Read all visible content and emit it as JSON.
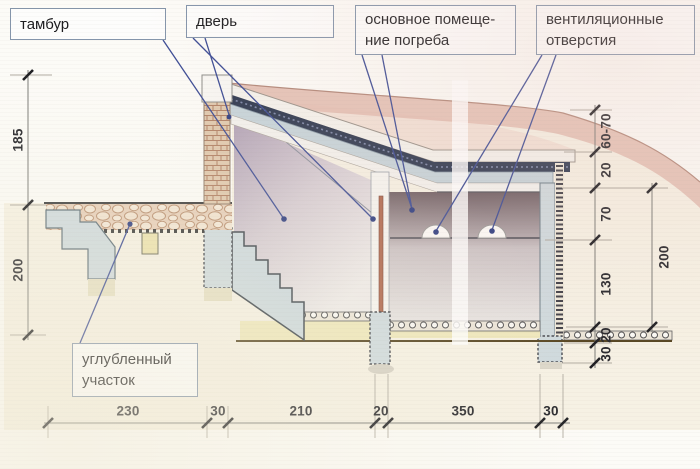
{
  "callouts": {
    "tambur": {
      "text": "тамбур"
    },
    "door": {
      "text": "дверь"
    },
    "main_room": {
      "line1": "основное помеще-",
      "line2": "ние погреба"
    },
    "vents": {
      "line1": "вентиляционные",
      "line2": "отверстия"
    },
    "recessed": {
      "line1": "углубленный",
      "line2": "участок"
    }
  },
  "dimensions": {
    "left": {
      "upper": "185",
      "lower": "200"
    },
    "right": {
      "d1": "60-70",
      "d2": "20",
      "d3": "70",
      "d4": "130",
      "d5": "20",
      "d6": "30",
      "outer": "200"
    },
    "bottom": {
      "d1": "230",
      "d2": "30",
      "d3": "210",
      "d4": "20",
      "d5": "350",
      "d6": "30"
    }
  },
  "colors": {
    "leader_blue": "#3c4c95",
    "earth_band": "#e3bfb2",
    "concrete": "#cfdade",
    "waterproofing": "#2e3950",
    "sand": "#efe8bc"
  }
}
